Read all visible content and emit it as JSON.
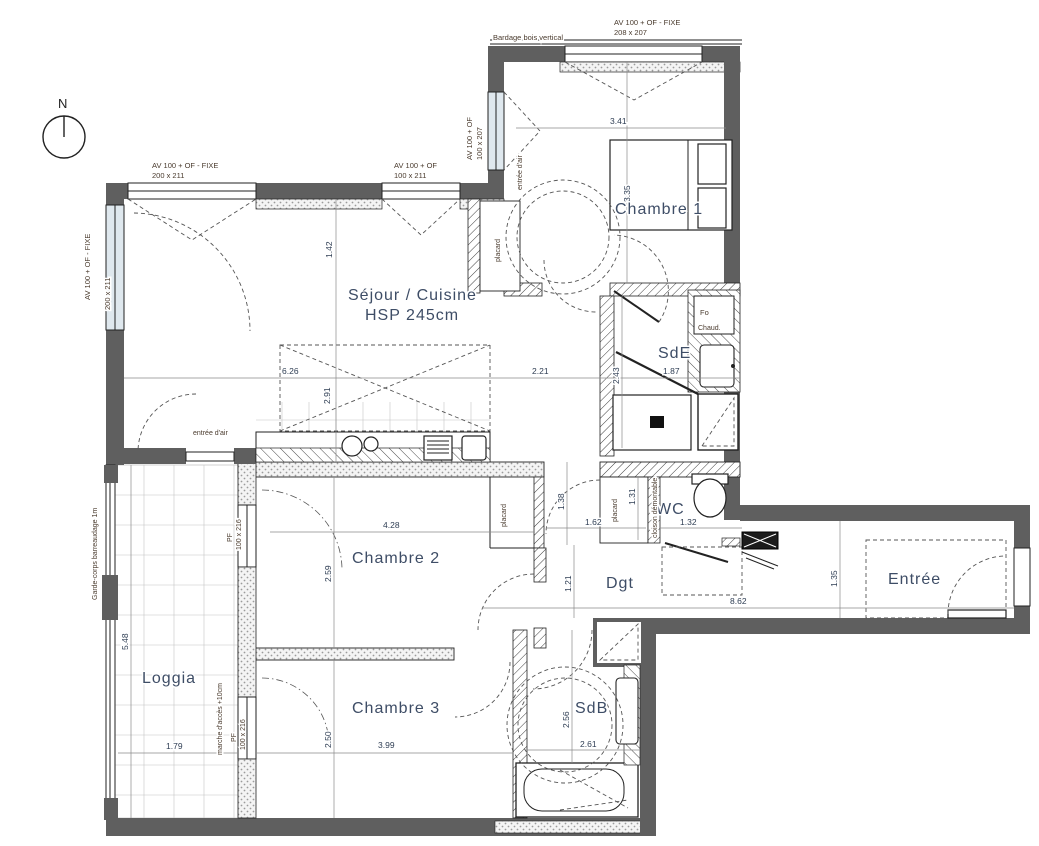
{
  "north": {
    "label": "N"
  },
  "rooms": {
    "chambre1": "Chambre 1",
    "sejour_line1": "Séjour / Cuisine",
    "sejour_line2": "HSP 245cm",
    "sde": "SdE",
    "wc": "WC",
    "entree": "Entrée",
    "dgt": "Dgt",
    "chambre2": "Chambre 2",
    "loggia": "Loggia",
    "chambre3": "Chambre 3",
    "sdb": "SdB"
  },
  "dimensions": {
    "chambre1_w": "3.41",
    "chambre1_h": "3.35",
    "sejour_h1": "1.42",
    "sejour_w": "6.26",
    "sejour_h2": "2.91",
    "sejour_w2": "2.21",
    "sde_h": "2.43",
    "sde_w": "1.87",
    "passage_h": "1.38",
    "wc_h": "1.31",
    "placard_w": "1.62",
    "wc_w": "1.32",
    "chambre2_w": "4.28",
    "chambre2_h": "2.59",
    "dgt_h": "1.21",
    "dgt_w": "8.62",
    "entree_h": "1.35",
    "loggia_h": "5.48",
    "loggia_w": "1.79",
    "chambre3_h": "2.50",
    "chambre3_w": "3.99",
    "sdb_h": "2.56",
    "sdb_w": "2.61"
  },
  "labels": {
    "bardage": "Bardage bois vertical",
    "av1_l1": "AV 100  + OF - FIXE",
    "av1_l2": "208 x 207",
    "av2_l1": "AV 100  + OF - FIXE",
    "av2_l2": "200 x 211",
    "av3_l1": "AV 100  + OF",
    "av3_l2": "100 x 211",
    "av4_l1": "AV 100  + OF - FIXE",
    "av4_l2": "200 x 211",
    "av5_l1": "AV 100  + OF",
    "av5_l2": "100 x 207",
    "entree_air_top": "entrée d'air",
    "entree_air_left": "entrée d'air",
    "placard_1": "placard",
    "placard_2": "placard",
    "placard_3": "placard",
    "cloison": "cloison démontable",
    "garde_corps": "Garde-corps barreaudage 1m",
    "pf1_l1": "PF",
    "pf1_l2": "100 x 216",
    "pf2_l1": "PF",
    "pf2_l2": "100 x 216",
    "marche": "marche d'accès +10cm",
    "fo": "Fo",
    "chaud": "Chaud."
  },
  "colors": {
    "wall": "#5f5f5f",
    "room_text": "#3e4d66",
    "annotation_text": "#4a3b2e"
  }
}
